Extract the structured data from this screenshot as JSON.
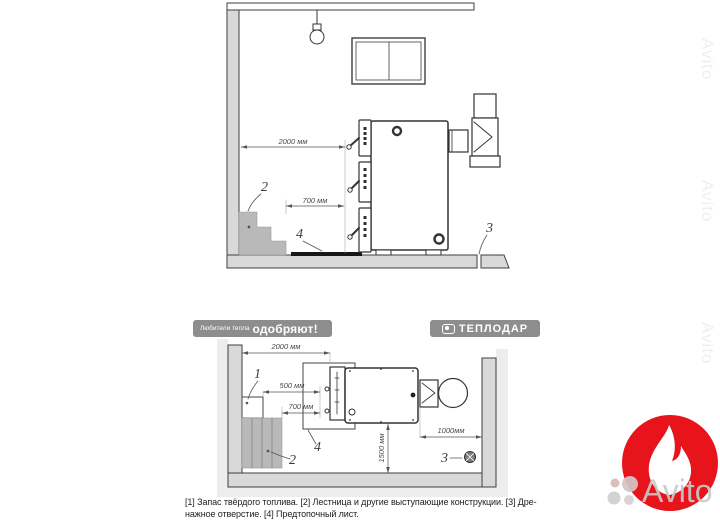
{
  "banner": {
    "tagline_prefix": "Любители тепла",
    "tagline_main": "одобряют!",
    "brand": "ТЕПЛОДАР",
    "pill_color": "#8d8d8d"
  },
  "top_view": {
    "dim_wall_to_boiler": "2000 мм",
    "dim_stairs_to_boiler": "700 мм",
    "label_stairs": "2",
    "label_drain": "3",
    "label_hearth_sheet": "4"
  },
  "plan_view": {
    "dim_wall_to_boiler": "2000 мм",
    "dim_fuel_to_boiler": "500 мм",
    "dim_stairs_to_boiler": "700 мм",
    "dim_boiler_to_wall": "1000мм",
    "dim_front_clearance": "1500 мм",
    "label_fuel": "1",
    "label_stairs": "2",
    "label_drain": "3",
    "label_hearth_sheet": "4"
  },
  "caption": {
    "line1": "[1] Запас твёрдого топлива. [2] Лестница и другие выступающие конструкции. [3] Дре-",
    "line2": "нажное отверстие. [4] Предтопочный лист."
  },
  "watermark": {
    "brand": "Avito",
    "edge_text": "Avito"
  },
  "colors": {
    "badge_red": "#e8141c",
    "wall_gray": "#d9d9d9",
    "stairs_gray": "#b9b9b9",
    "line_dark": "#3a3a3a",
    "banner_gray": "#8d8d8d"
  }
}
